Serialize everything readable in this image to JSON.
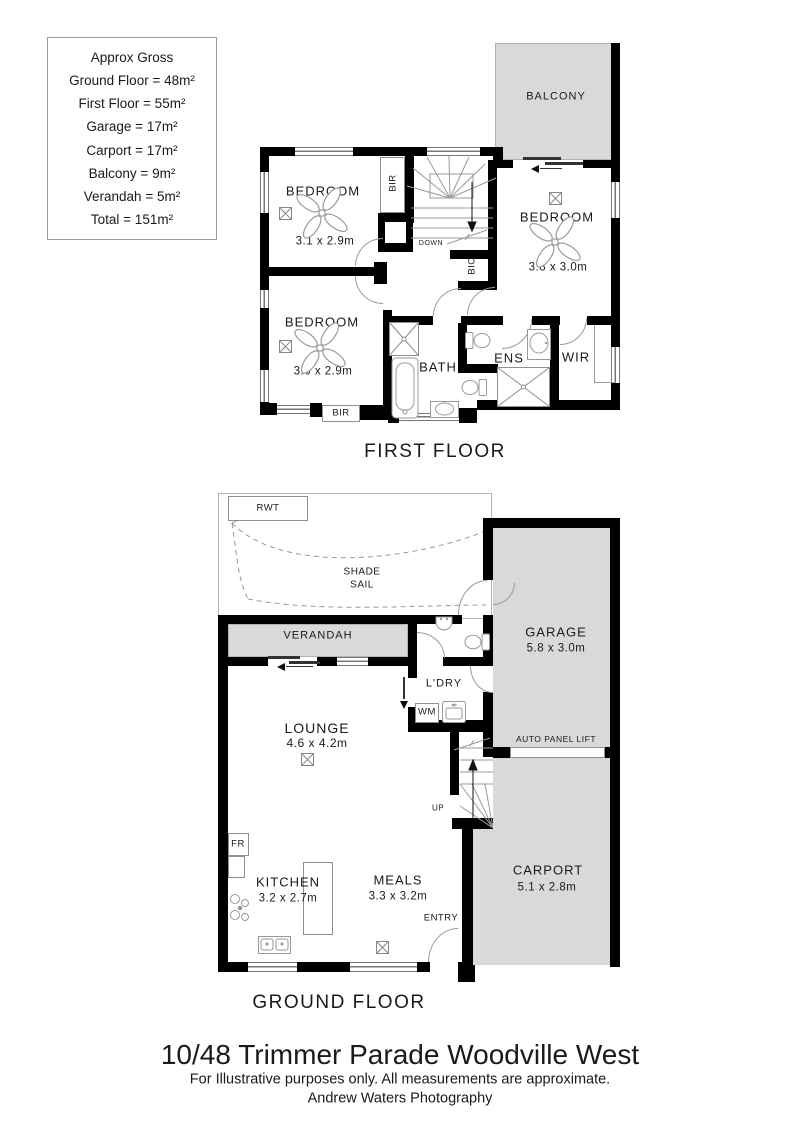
{
  "info_box": {
    "title": "Approx Gross",
    "lines": [
      "Ground Floor = 48m²",
      "First Floor = 55m²",
      "Garage = 17m²",
      "Carport = 17m²",
      "Balcony = 9m²",
      "Verandah = 5m²",
      "Total = 151m²"
    ]
  },
  "first_floor": {
    "title": "FIRST FLOOR",
    "balcony": "BALCONY",
    "bedroom1": {
      "name": "BEDROOM",
      "dims": "3.1 x 2.9m"
    },
    "bedroom2": {
      "name": "BEDROOM",
      "dims": "3.8 x 3.0m"
    },
    "bedroom3": {
      "name": "BEDROOM",
      "dims": "3.0 x 2.9m"
    },
    "bath": "BATH",
    "ens": "ENS",
    "wir": "WIR",
    "bir_top": "BIR",
    "bir_bottom": "BIR",
    "bic": "BIC",
    "down": "DOWN"
  },
  "ground_floor": {
    "title": "GROUND FLOOR",
    "rwt": "RWT",
    "shade_sail": {
      "line1": "SHADE",
      "line2": "SAIL"
    },
    "verandah": "VERANDAH",
    "garage": {
      "name": "GARAGE",
      "dims": "5.8 x 3.0m"
    },
    "lounge": {
      "name": "LOUNGE",
      "dims": "4.6 x 4.2m"
    },
    "laundry": "L'DRY",
    "wm": "WM",
    "auto_panel_lift": "AUTO PANEL LIFT",
    "up": "UP",
    "carport": {
      "name": "CARPORT",
      "dims": "5.1 x 2.8m"
    },
    "fridge": "FR",
    "kitchen": {
      "name": "KITCHEN",
      "dims": "3.2 x 2.7m"
    },
    "meals": {
      "name": "MEALS",
      "dims": "3.3 x 3.2m"
    },
    "entry": "ENTRY"
  },
  "footer": {
    "address": "10/48 Trimmer Parade Woodville West",
    "disclaimer": "For Illustrative purposes only.  All measurements are approximate.",
    "credit": "Andrew Waters Photography"
  },
  "colors": {
    "area_fill": "#d9d9d9",
    "wall": "#000000"
  }
}
